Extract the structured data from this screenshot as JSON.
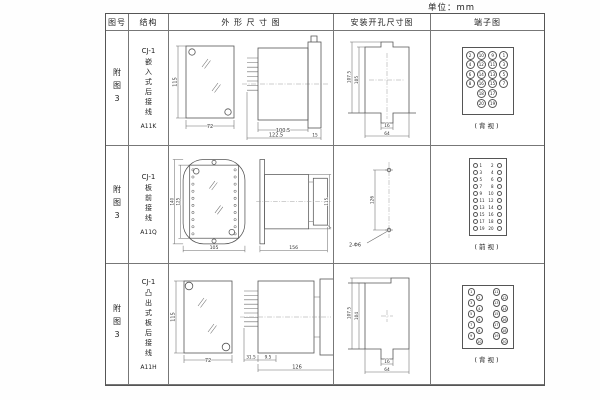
{
  "unit_label": "单位：mm",
  "header": {
    "fig": "图号",
    "structure": "结构",
    "outline": "外 形 尺 寸 图",
    "mounting": "安装开孔尺寸图",
    "terminal": "端子图"
  },
  "rows": [
    {
      "fig": "附图3",
      "series": "CJ-1",
      "structure_chars": "嵌入式后接线",
      "model": "A11K",
      "outline": {
        "front_h": "115",
        "front_w": "72",
        "body_len": "100.5",
        "total_len": "122.5",
        "flange": "15"
      },
      "mounting": {
        "outer_h": "107.5",
        "inner_h": "105",
        "slot_w": "16",
        "opening_w": "64"
      },
      "terminal": {
        "view_label": "(背视)",
        "grid": [
          [
            "2",
            "10",
            "9",
            "1"
          ],
          [
            "4",
            "12",
            "11",
            "3"
          ],
          [
            "6",
            "14",
            "13",
            "5"
          ],
          [
            "8",
            "16",
            "15",
            "7"
          ],
          [
            "",
            "18",
            "17",
            ""
          ],
          [
            "",
            "20",
            "19",
            ""
          ]
        ]
      }
    },
    {
      "fig": "附图3",
      "series": "CJ-1",
      "structure_chars": "板前接线",
      "model": "A11Q",
      "outline": {
        "front_h": "140",
        "inner_h": "125",
        "front_w": "105",
        "side_len": "156",
        "side_h": "115"
      },
      "mounting": {
        "hole_spacing": "126",
        "hole_label": "2-Φ6"
      },
      "terminal": {
        "view_label": "(前视)",
        "left": [
          "1",
          "3",
          "5",
          "7",
          "9",
          "11",
          "13",
          "15",
          "17",
          "19"
        ],
        "right": [
          "2",
          "4",
          "6",
          "8",
          "10",
          "12",
          "14",
          "16",
          "18",
          "20"
        ]
      }
    },
    {
      "fig": "附图3",
      "series": "CJ-1",
      "structure_chars": "凸出式板后接线",
      "model": "A11H",
      "outline": {
        "front_h": "115",
        "front_w": "72",
        "pin_len": "31.5",
        "gap": "9.5",
        "total_len": "126"
      },
      "mounting": {
        "outer_h": "107.5",
        "inner_h": "104",
        "slot_w": "16",
        "opening_w": "64"
      },
      "terminal": {
        "view_label": "(背视)",
        "zigzag_left": [
          "1",
          "2",
          "3",
          "4",
          "5",
          "6",
          "7",
          "8",
          "9",
          "10"
        ],
        "zigzag_right": [
          "11",
          "12",
          "13",
          "14",
          "15",
          "16",
          "17",
          "18",
          "19",
          "20"
        ]
      }
    }
  ]
}
